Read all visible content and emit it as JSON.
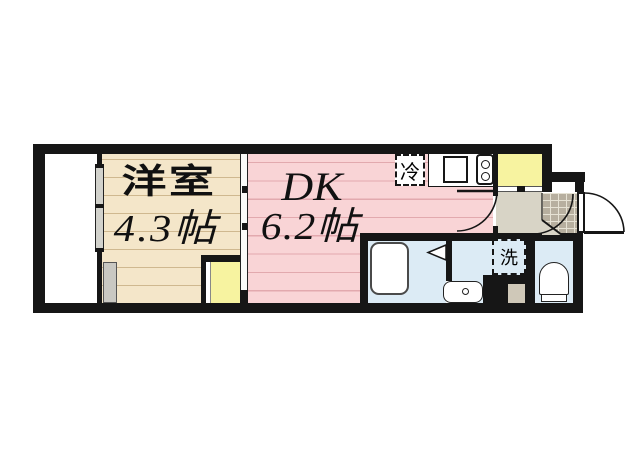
{
  "floor_plan": {
    "type": "apartment-floor-plan",
    "rooms": {
      "western": {
        "name": "洋室",
        "size": "4.3帖"
      },
      "dk": {
        "name": "DK",
        "size": "6.2帖"
      }
    },
    "fixtures": {
      "refrigerator": "冷",
      "washer": "洗"
    },
    "features": [
      "balcony",
      "sliding-window",
      "sliding-partition",
      "closet",
      "kitchen-counter",
      "sink",
      "two-burner-stove",
      "refrigerator-space",
      "shoe-closet",
      "hallway",
      "entrance-genkan-tile",
      "front-door-swing",
      "interior-door-swings",
      "bathtub",
      "folding-bath-door",
      "vanity-basin",
      "washing-machine-space",
      "toilet"
    ],
    "colors": {
      "wall": "#161616",
      "western_room": "#f4e6c9",
      "western_room_line": "#cfb88f",
      "dk": "#f9d4d6",
      "dk_line": "#e2a9ae",
      "closet_yellow": "#f7f3a0",
      "wet_area_blue": "#dcebf5",
      "hallway_tan": "#d8d4c6",
      "genkan_tile": "#b7af9f",
      "pillar_gray": "#c9c8c2",
      "step_tan": "#cfc8b8",
      "fixture_white": "#ffffff"
    }
  }
}
